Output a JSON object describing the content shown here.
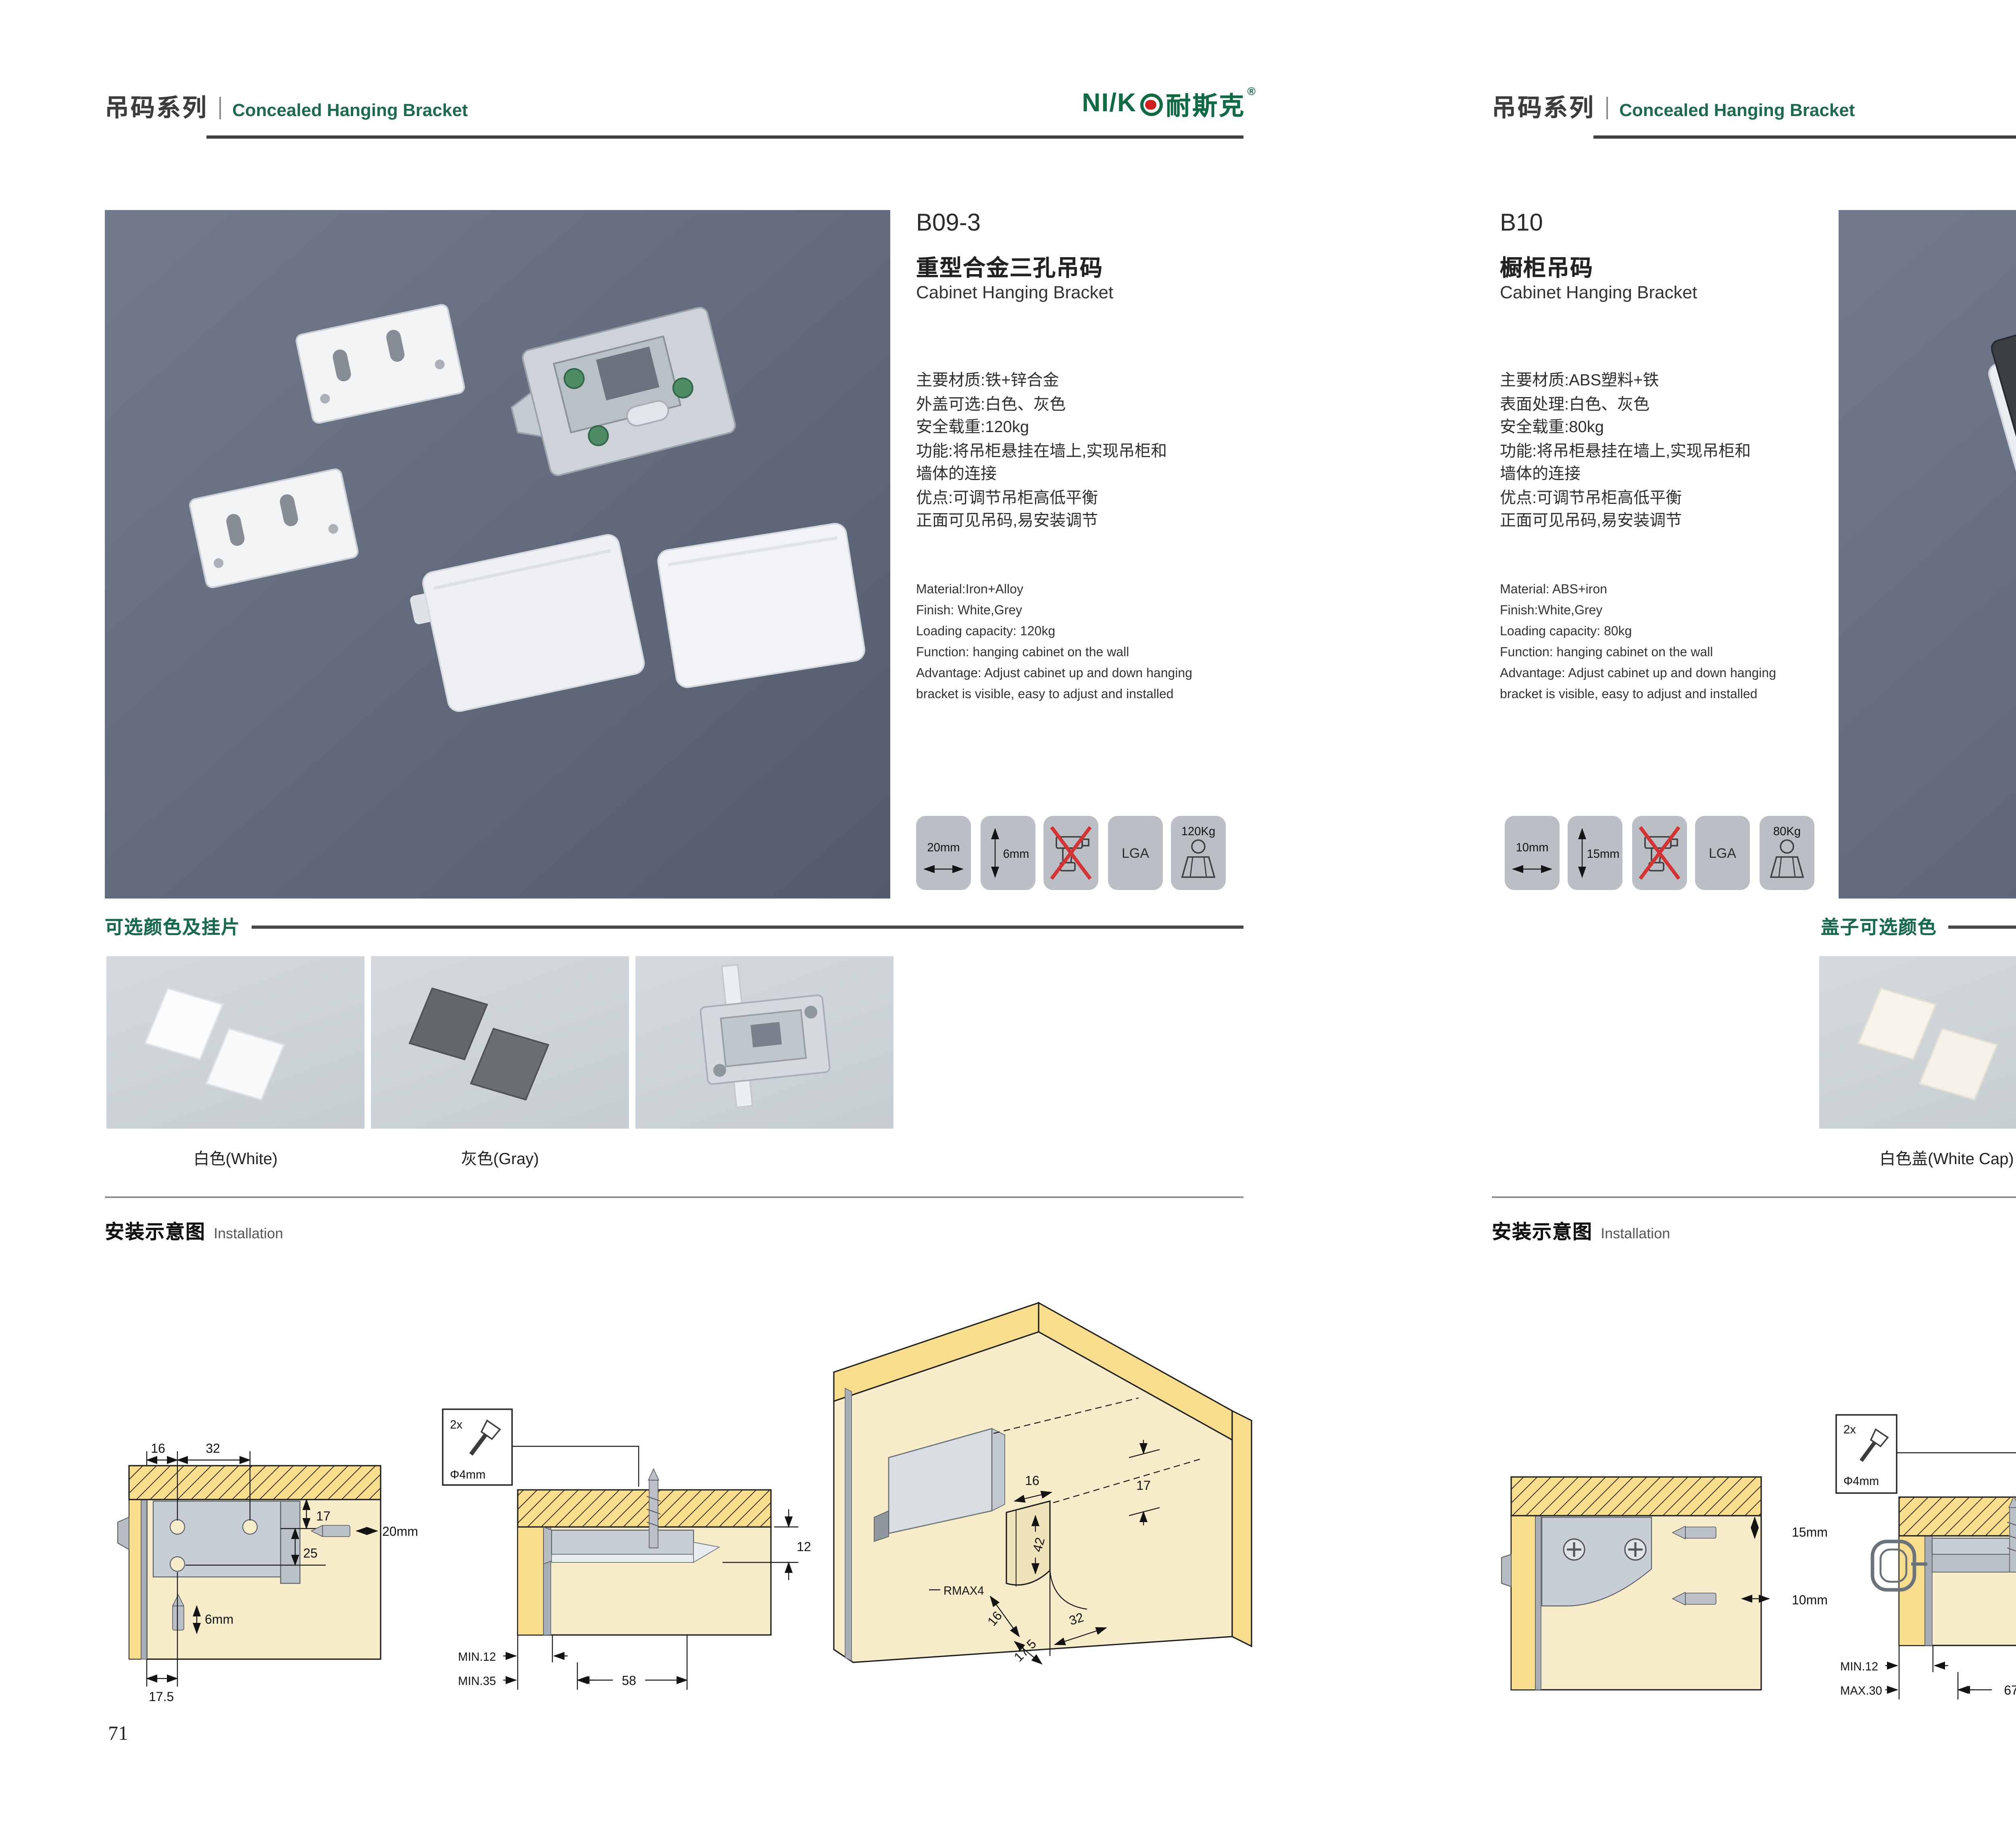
{
  "brand": {
    "logo_latin": "NI/K",
    "logo_cjk": "耐斯克",
    "reg": "®"
  },
  "pages": [
    {
      "page_no": "71",
      "header": {
        "series_cn": "吊码系列",
        "series_en": "Concealed Hanging Bracket"
      },
      "product": {
        "code": "B09-3",
        "name_cn": "重型合金三孔吊码",
        "name_en": "Cabinet Hanging Bracket",
        "specs_cn": "主要材质:铁+锌合金\n外盖可选:白色、灰色\n安全载重:120kg\n功能:将吊柜悬挂在墙上,实现吊柜和\n墙体的连接\n优点:可调节吊柜高低平衡\n正面可见吊码,易安装调节",
        "specs_en": "Material:Iron+Alloy\nFinish: White,Grey\nLoading capacity: 120kg\nFunction: hanging cabinet on the wall\nAdvantage: Adjust cabinet up and down hanging\nbracket is visible, easy to adjust and installed"
      },
      "icons": {
        "i1": "20mm",
        "i2": "6mm",
        "i4": "LGA",
        "i5": "120Kg"
      },
      "colors_section": {
        "title": "可选颜色及挂片",
        "label1": "白色(White)",
        "label2": "灰色(Gray)"
      },
      "install": {
        "title_cn": "安装示意图",
        "title_en": "Installation",
        "d1": {
          "a": "16",
          "b": "32",
          "c": "17",
          "d": "25",
          "e": "20mm",
          "f": "6mm",
          "g": "17.5"
        },
        "d2": {
          "qty": "2x",
          "dia": "Φ4mm",
          "a": "12",
          "b": "MIN.12",
          "c": "MIN.35",
          "d": "58"
        },
        "d3": {
          "a": "16",
          "b": "17",
          "c": "42",
          "d": "RMAX4",
          "e": "16",
          "f": "17.5",
          "g": "32"
        }
      }
    },
    {
      "page_no": "72",
      "header": {
        "series_cn": "吊码系列",
        "series_en": "Concealed Hanging Bracket"
      },
      "product": {
        "code": "B10",
        "name_cn": "橱柜吊码",
        "name_en": "Cabinet Hanging Bracket",
        "specs_cn": "主要材质:ABS塑料+铁\n表面处理:白色、灰色\n安全载重:80kg\n功能:将吊柜悬挂在墙上,实现吊柜和\n墙体的连接\n优点:可调节吊柜高低平衡\n正面可见吊码,易安装调节",
        "specs_en": "Material: ABS+iron\nFinish:White,Grey\nLoading capacity: 80kg\nFunction: hanging cabinet on the wall\nAdvantage: Adjust cabinet up and down hanging\nbracket is visible, easy to adjust and installed"
      },
      "icons": {
        "i1": "10mm",
        "i2": "15mm",
        "i4": "LGA",
        "i5": "80Kg"
      },
      "colors_section": {
        "title": "盖子可选颜色",
        "label1": "白色盖(White Cap)",
        "label2": "灰色盖(Gray Cap)"
      },
      "install": {
        "title_cn": "安装示意图",
        "title_en": "Installation",
        "d1": {
          "a": "15mm",
          "b": "10mm"
        },
        "d2": {
          "qty": "2x",
          "dia": "Φ4mm",
          "a": "18",
          "b": "MIN.12",
          "c": "MAX.30",
          "d": "67"
        },
        "d3": {
          "a": "13",
          "b": "42",
          "c": "RMAX4",
          "d": "19",
          "e": "17",
          "f": "32"
        }
      }
    }
  ]
}
